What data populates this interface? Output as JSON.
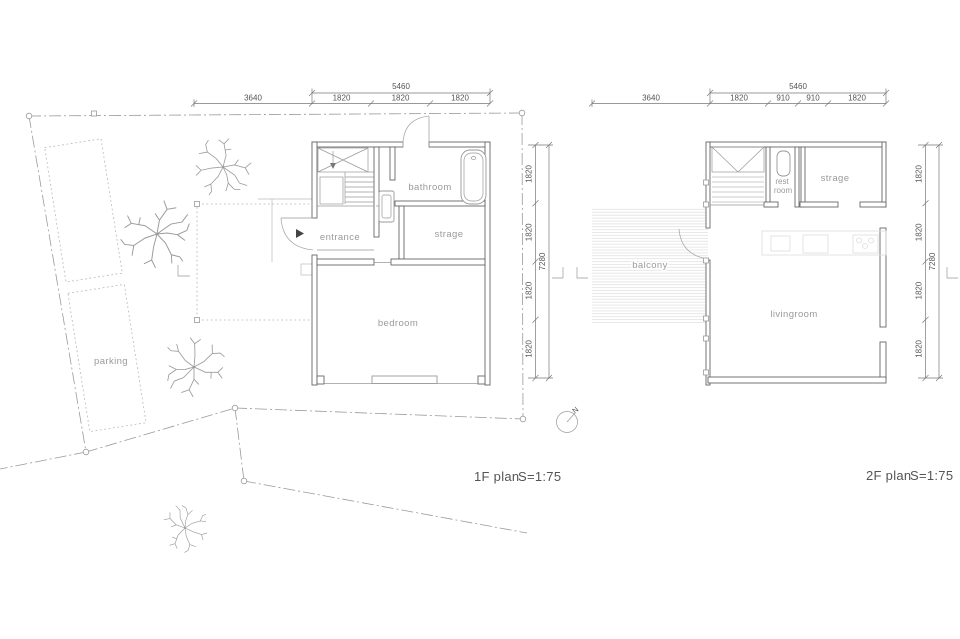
{
  "plan1f": {
    "title": "1F plan",
    "scale": "S=1:75",
    "rooms": {
      "entrance": "entrance",
      "bathroom": "bathroom",
      "strage": "strage",
      "bedroom": "bedroom"
    },
    "dims": {
      "top_total": "5460",
      "top_left": "3640",
      "seg1": "1820",
      "seg2": "1820",
      "seg3": "1820",
      "right1": "1820",
      "right2": "1820",
      "right3": "1820",
      "right4": "1820",
      "right_total": "7280"
    }
  },
  "plan2f": {
    "title": "2F plan",
    "scale": "S=1:75",
    "rooms": {
      "rest1": "rest",
      "rest2": "room",
      "strage": "strage",
      "livingroom": "livingroom",
      "balcony": "balcony"
    },
    "dims": {
      "top_total": "5460",
      "top_left": "3640",
      "seg1": "1820",
      "seg2": "910",
      "seg3": "910",
      "seg4": "1820",
      "right1": "1820",
      "right2": "1820",
      "right3": "1820",
      "right4": "1820",
      "right_total": "7280"
    }
  },
  "site": {
    "parking": "parking"
  },
  "north": {
    "label": "N"
  },
  "colors": {
    "wall": "#666666",
    "dim": "#777777",
    "label": "#9a9a9a",
    "boundary": "#9a9a9a"
  }
}
